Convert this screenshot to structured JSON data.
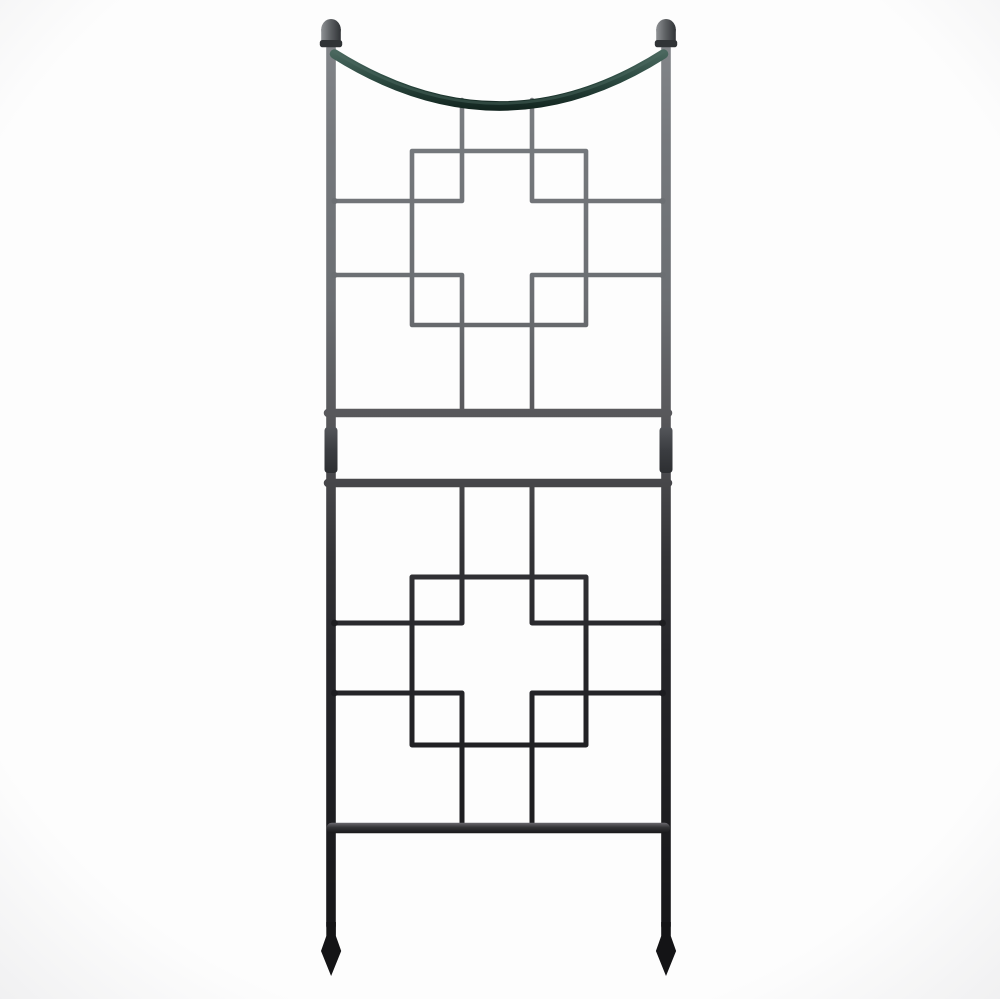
{
  "scene": {
    "description": "Graphite wrought-iron garden trellis photographed on a plain white background: two ladder-framed panels each holding a square-on-cross lattice motif, joined by twin horizontal rails with post couplers, topped by a downward-curved dark-green swag bar between two ball finials, and ending in straight legs with pointed spear feet.",
    "object": "garden-trellis",
    "colors": {
      "background": "#fdfdfd",
      "vignette": "#f0f0f1",
      "steel_top": "#85888c",
      "steel_upper": "#75787c",
      "steel_upper2": "#6b6e72",
      "steel_mid": "#58585b",
      "steel_mid2": "#47474a",
      "steel_dark": "#333336",
      "steel_lower": "#26262a",
      "steel_bottom": "#141416",
      "swag_highlight": "#4e6b62",
      "swag_teal": "#2e4c43",
      "swag_dark": "#0e1f1a",
      "finial_light": "#8f9295",
      "finial_mid": "#5f6265",
      "finial_dark": "#303336",
      "rail_sheen": "#747278",
      "coupler": "#3b3d41",
      "weld": "#1c1c1f"
    }
  }
}
